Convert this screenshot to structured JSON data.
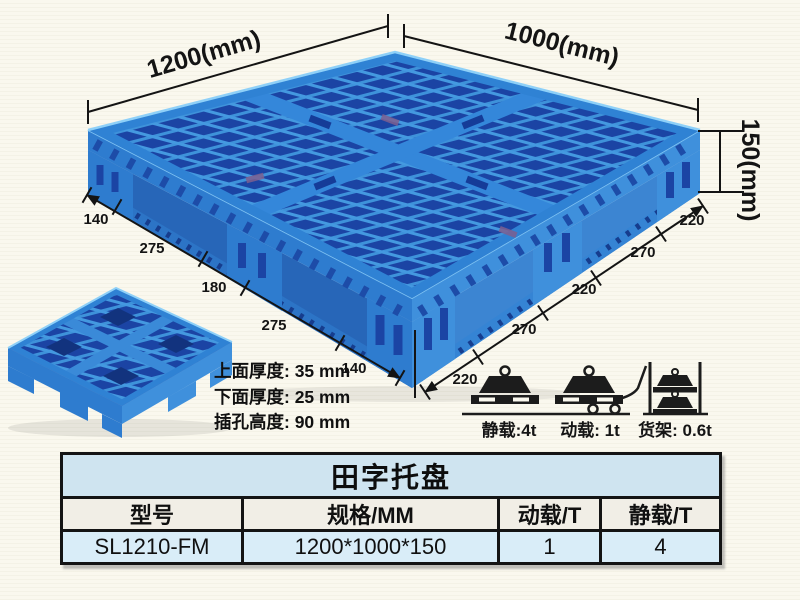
{
  "illustration": {
    "dim_length": "1200(mm)",
    "dim_width": "1000(mm)",
    "dim_height": "150(mm)",
    "left_edge_dims": [
      "140",
      "275",
      "180",
      "275",
      "140"
    ],
    "right_edge_dims": [
      "220",
      "270",
      "220",
      "270",
      "220"
    ],
    "thickness_notes": [
      "上面厚度: 35 mm",
      "下面厚度: 25 mm",
      "插孔高度: 90 mm"
    ],
    "load_labels": {
      "static": "静载:4t",
      "dynamic": "动载: 1t",
      "rack": "货架: 0.6t"
    }
  },
  "spec_table": {
    "title": "田字托盘",
    "headers": [
      "型号",
      "规格/MM",
      "动载/T",
      "静载/T"
    ],
    "rows": [
      {
        "model": "SL1210-FM",
        "spec": "1200*1000*150",
        "dynamic_load": "1",
        "static_load": "4"
      }
    ]
  },
  "colors": {
    "pallet_blue": "#2e7ccf",
    "pallet_dark_blue": "#1b44a4",
    "pallet_rib_blue": "#3e92da",
    "pallet_light_blue": "#4aa0e4",
    "background_cream": "#faf8ee",
    "table_title_bg": "#cfe4f0",
    "table_header_bg": "#f1eee6",
    "table_row_bg": "#d9edf8",
    "line_black": "#141414"
  }
}
